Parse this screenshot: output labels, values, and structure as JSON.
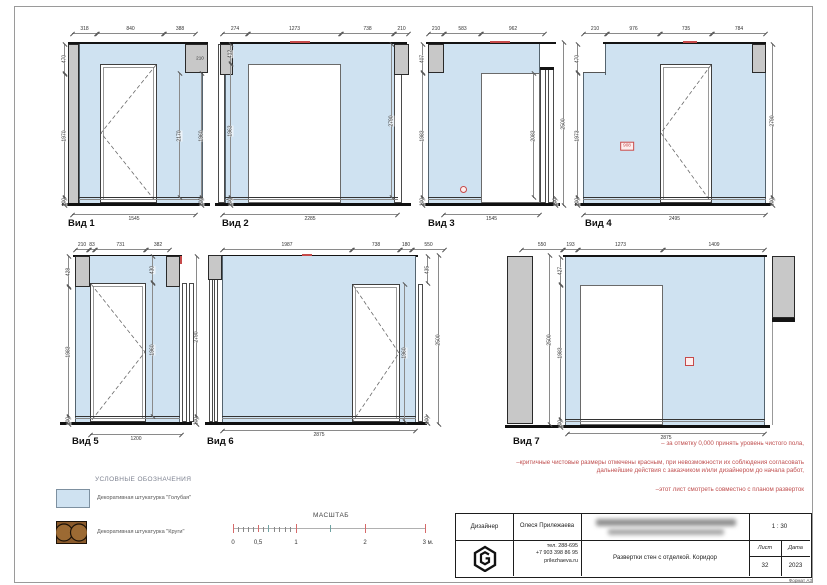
{
  "views": [
    {
      "title": "Вид 1",
      "dims": {
        "top": [
          "318",
          "840",
          "388"
        ],
        "left": [
          "470",
          "1970",
          "100"
        ],
        "right": [
          "210",
          "2170",
          "1960",
          "100"
        ],
        "bottom": "1545"
      }
    },
    {
      "title": "Вид 2",
      "dims": {
        "top": [
          "274",
          "1273",
          "738",
          "210"
        ],
        "left": [
          "412",
          "1963",
          "100"
        ],
        "right": [
          "2790"
        ],
        "bottom": "2285"
      }
    },
    {
      "title": "Вид 3",
      "dims": {
        "top": [
          "210",
          "583",
          "962"
        ],
        "left": [
          "407",
          "1983",
          "100"
        ],
        "right": [
          "2083",
          "2500",
          "100"
        ],
        "bottom": "1545"
      }
    },
    {
      "title": "Вид 4",
      "dims": {
        "top": [
          "210",
          "976",
          "735",
          "784"
        ],
        "left": [
          "470",
          "1973",
          "100"
        ],
        "right": [
          "2790",
          "100"
        ],
        "bottom": "2495",
        "red_mark": "908"
      }
    },
    {
      "title": "Вид 5",
      "dims": {
        "top": [
          "210",
          "83",
          "731",
          "382"
        ],
        "left": [
          "428",
          "1983",
          "100"
        ],
        "inner": [
          "430",
          "1960"
        ],
        "right": [
          "2790",
          "100"
        ],
        "bottom": "1200"
      }
    },
    {
      "title": "Вид 6",
      "dims": {
        "top": [
          "1987",
          "738",
          "180",
          "550"
        ],
        "inner": [
          "1960"
        ],
        "right": [
          "435",
          "2500",
          "100"
        ],
        "bottom": "2875"
      }
    },
    {
      "title": "Вид 7",
      "dims": {
        "top": [
          "550",
          "193",
          "1273",
          "1409"
        ],
        "left": [
          "2500",
          "427",
          "1983",
          "100"
        ],
        "bottom": "2875"
      }
    }
  ],
  "notes": {
    "lines": [
      "–  за отметку 0,000 принять уровень чистого пола,",
      "–критичные чистовые размеры отмечены красным, при невозможности их соблюдения согласовать",
      "дальнейшие действия с заказчиком и/или дизайнером до начала работ,",
      "–этот лист смотреть совместно с планом разверток"
    ]
  },
  "legend": {
    "title": "УСЛОВНЫЕ ОБОЗНАЧЕНИЯ",
    "items": [
      {
        "label": "Декоративная штукатурка \"Голубая\""
      },
      {
        "label": "Декоративная штукатурка \"Круги\""
      }
    ]
  },
  "scalebar": {
    "title": "МАСШТАБ",
    "ticks": [
      "0",
      "0,5",
      "1",
      "2",
      "3 м."
    ]
  },
  "titleblock": {
    "designer_label": "Дизайнер",
    "designer_name": "Олеся Прилежаева",
    "scale": "1 : 30",
    "phone1": "тел. 288-695",
    "phone2": "+7 903 398 86 95",
    "site": "prilezhaeva.ru",
    "drawing_title": "Развертки стен с отделкой. Коридор",
    "sheet_label": "Лист",
    "sheet_value": "32",
    "date_label": "Дата",
    "date_value": "2023",
    "format": "Формат А3"
  },
  "colors": {
    "wall_blue": "#cfe2f1",
    "concrete_grey": "#c8c8c8",
    "accent_red": "#c64a4a",
    "plaster_brown": "#8a5a2b"
  }
}
